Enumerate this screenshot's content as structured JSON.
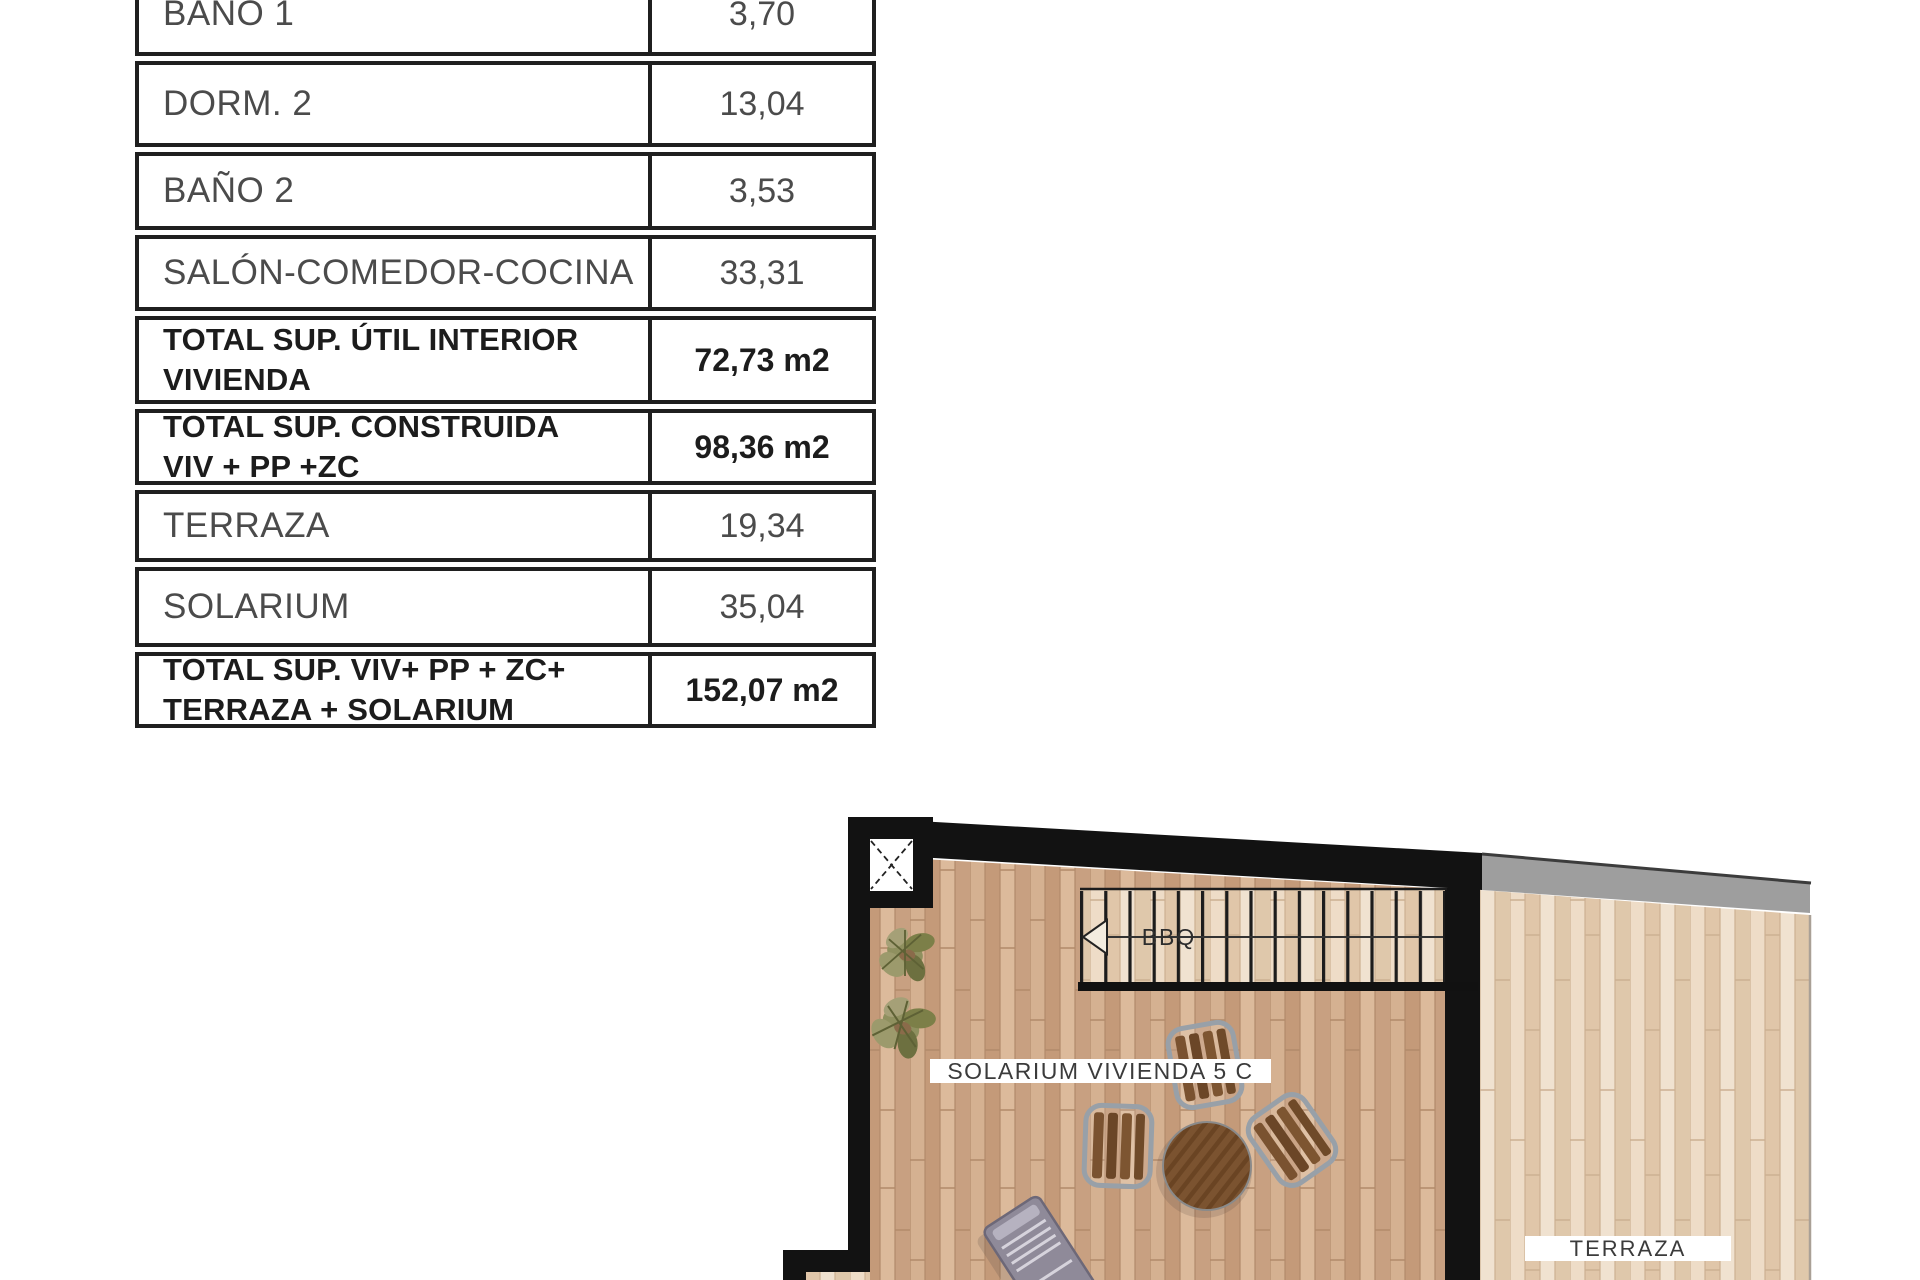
{
  "table": {
    "rows": [
      {
        "label": "BAÑO 1",
        "label2": "",
        "value": "3,70"
      },
      {
        "label": "DORM. 2",
        "label2": "",
        "value": "13,04"
      },
      {
        "label": "BAÑO 2",
        "label2": "",
        "value": "3,53"
      },
      {
        "label": "SALÓN-COMEDOR-COCINA",
        "label2": "",
        "value": "33,31"
      },
      {
        "label": "TOTAL SUP. ÚTIL INTERIOR",
        "label2": "VIVIENDA",
        "value": "72,73 m2"
      },
      {
        "label": "TOTAL SUP. CONSTRUIDA",
        "label2": "VIV + PP +ZC",
        "value": "98,36 m2"
      },
      {
        "label": "TERRAZA",
        "label2": "",
        "value": "19,34"
      },
      {
        "label": "SOLARIUM",
        "label2": "",
        "value": "35,04"
      },
      {
        "label": "TOTAL SUP. VIV+ PP + ZC+",
        "label2": "TERRAZA + SOLARIUM",
        "value": "152,07 m2"
      }
    ]
  },
  "floorplan": {
    "solarium_label": "SOLARIUM VIVIENDA 5 C",
    "terraza_label": "TERRAZA",
    "bbq_label": "BBQ"
  },
  "colors": {
    "wall_black": "#121212",
    "wood_solarium": "#cda487",
    "wood_terraza": "#e7d3bb",
    "parapet_gray": "#9e9e9e",
    "plant_green": "#8f905f",
    "furniture_brown": "#7a5230",
    "lounger_gray": "#8f8a99",
    "table_border": "#1f1f1f"
  }
}
